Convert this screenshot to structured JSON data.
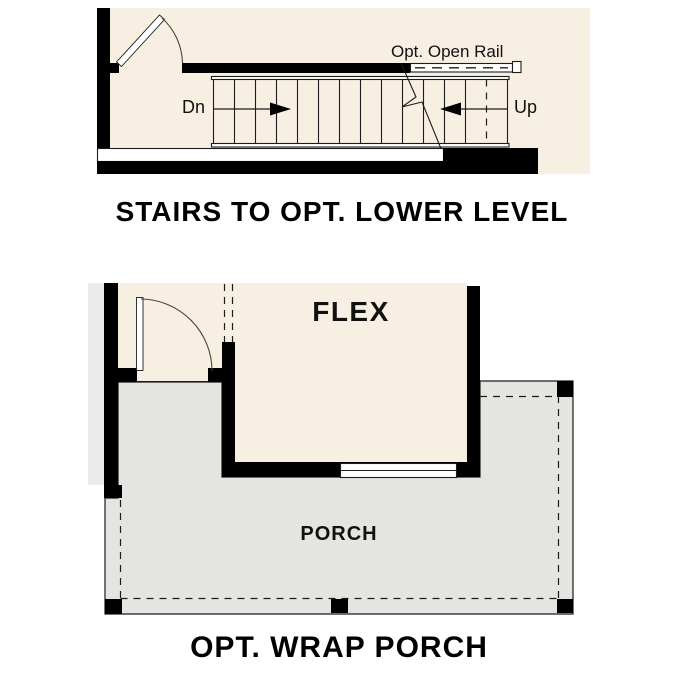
{
  "stairs_diagram": {
    "title": "STAIRS TO OPT. LOWER LEVEL",
    "open_rail_label": "Opt. Open Rail",
    "down_label": "Dn",
    "up_label": "Up"
  },
  "porch_diagram": {
    "title": "OPT. WRAP PORCH",
    "flex_room_label": "FLEX",
    "porch_label": "PORCH"
  },
  "colors": {
    "floor_cream": "#f7efe1",
    "porch_gray": "#e4e4e1",
    "wall_black": "#000000",
    "line_dark": "#1c1c1c"
  }
}
